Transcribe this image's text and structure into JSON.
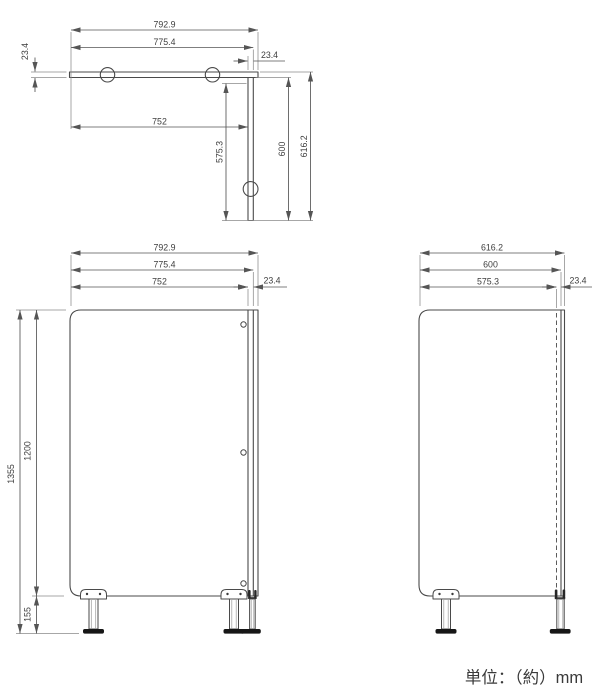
{
  "unit_note": "単位：（約）mm",
  "colors": {
    "line": "#4a4a4a",
    "dim_line": "#555555",
    "ext_line": "#8a8a8a",
    "text": "#3d3d3d",
    "foot": "#161616",
    "background": "#ffffff"
  },
  "plan": {
    "dims": {
      "w_outer": "792.9",
      "w_mid": "775.4",
      "w_inner": "752",
      "t_left": "23.4",
      "t_right": "23.4",
      "d_inner": "575.3",
      "d_mid": "600",
      "d_outer": "616.2"
    }
  },
  "front": {
    "dims": {
      "w_outer": "792.9",
      "w_mid": "775.4",
      "w_inner": "752",
      "t_right": "23.4",
      "h_total": "1355",
      "h_panel": "1200",
      "h_leg": "155"
    }
  },
  "side": {
    "dims": {
      "d_outer": "616.2",
      "d_mid": "600",
      "d_inner": "575.3",
      "t_right": "23.4"
    }
  }
}
